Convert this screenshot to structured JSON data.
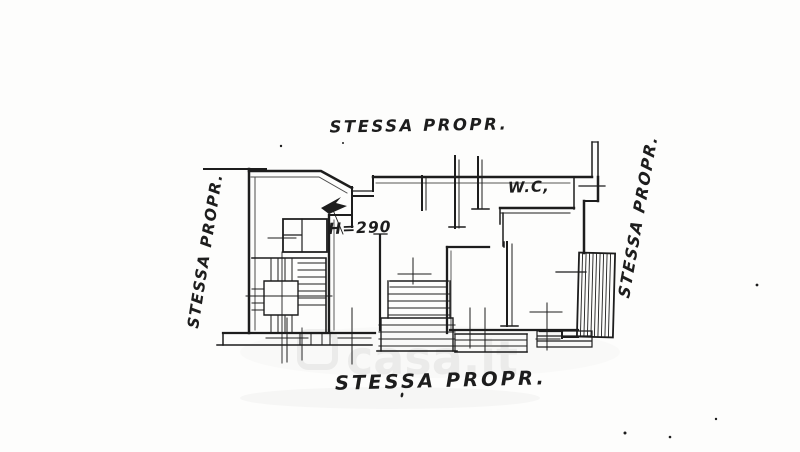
{
  "plan": {
    "labels": {
      "top": "STESSA PROPR.",
      "bottom": "STESSA PROPR.",
      "left": "STESSA PROPR.",
      "right": "STESSA PROPR."
    },
    "rooms": {
      "wc": "W.C,"
    },
    "annotations": {
      "ceiling_height": "H=290"
    },
    "colors": {
      "ink": "#1d1d1d",
      "paper": "#fdfdfc",
      "watermark_gray": "#ebebe9"
    }
  },
  "watermark": {
    "text": "casa.it"
  }
}
